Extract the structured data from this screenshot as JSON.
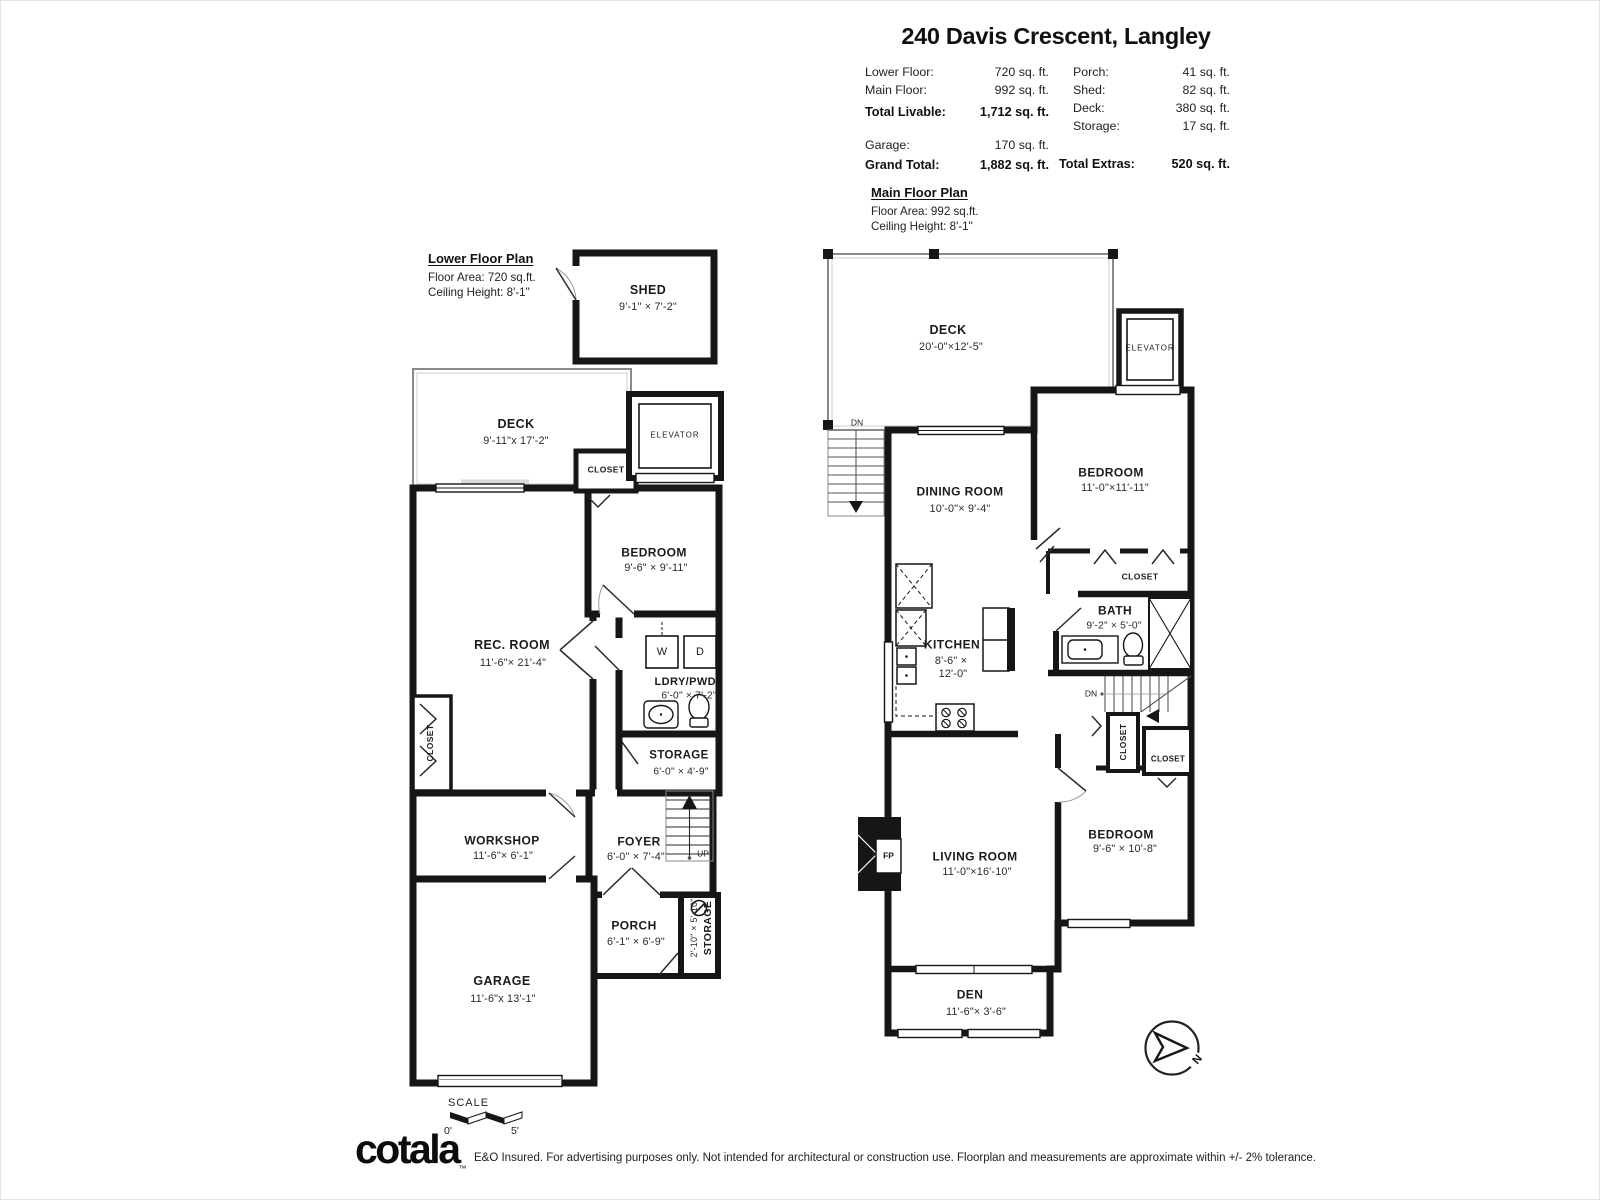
{
  "header": {
    "title": "240 Davis Crescent, Langley",
    "left_stats": [
      {
        "label": "Lower Floor:",
        "value": "720 sq. ft."
      },
      {
        "label": "Main Floor:",
        "value": "992 sq. ft."
      },
      {
        "label": "Total Livable:",
        "value": "1,712 sq. ft."
      },
      {
        "label": "Garage:",
        "value": "170 sq. ft."
      },
      {
        "label": "Grand Total:",
        "value": "1,882 sq. ft."
      }
    ],
    "right_stats": [
      {
        "label": "Porch:",
        "value": "41 sq. ft."
      },
      {
        "label": "Shed:",
        "value": "82 sq. ft."
      },
      {
        "label": "Deck:",
        "value": "380 sq. ft."
      },
      {
        "label": "Storage:",
        "value": "17 sq. ft."
      },
      {
        "label": "Total Extras:",
        "value": "520 sq. ft."
      }
    ]
  },
  "lower_plan": {
    "heading": "Lower Floor Plan",
    "floor_area": "Floor Area: 720 sq.ft.",
    "ceiling_height": "Ceiling Height: 8'-1\"",
    "rooms": {
      "shed": {
        "name": "SHED",
        "dims": "9'-1\" × 7'-2\""
      },
      "deck": {
        "name": "DECK",
        "dims": "9'-11\"x 17'-2\""
      },
      "elevator": {
        "name": "ELEVATOR"
      },
      "closet_top": {
        "name": "CLOSET"
      },
      "bedroom": {
        "name": "BEDROOM",
        "dims": "9'-6\" × 9'-11\""
      },
      "rec_room": {
        "name": "REC. ROOM",
        "dims": "11'-6\"× 21'-4\""
      },
      "laundry": {
        "name": "LDRY/PWD.",
        "dims": "6'-0\" × 7'-2\"",
        "washer": "W",
        "dryer": "D"
      },
      "storage": {
        "name": "STORAGE",
        "dims": "6'-0\" × 4'-9\""
      },
      "closet_left": {
        "name": "CLOSET"
      },
      "workshop": {
        "name": "WORKSHOP",
        "dims": "11'-6\"× 6'-1\""
      },
      "foyer": {
        "name": "FOYER",
        "dims": "6'-0\" × 7'-4\"",
        "stairs": "UP"
      },
      "porch": {
        "name": "PORCH",
        "dims": "6'-1\" × 6'-9\""
      },
      "storage_side": {
        "name": "STORAGE",
        "dims": "2'-10\" × 5'-10\""
      },
      "garage": {
        "name": "GARAGE",
        "dims": "11'-6\"x 13'-1\""
      }
    }
  },
  "main_plan": {
    "heading": "Main Floor Plan",
    "floor_area": "Floor Area: 992 sq.ft.",
    "ceiling_height": "Ceiling Height: 8'-1\"",
    "rooms": {
      "deck": {
        "name": "DECK",
        "dims": "20'-0\"×12'-5\""
      },
      "stairs_top": {
        "label": "DN"
      },
      "elevator": {
        "name": "ELEVATOR"
      },
      "dining": {
        "name": "DINING ROOM",
        "dims": "10'-0\"× 9'-4\""
      },
      "bedroom1": {
        "name": "BEDROOM",
        "dims": "11'-0\"×11'-11\""
      },
      "closet1": {
        "name": "CLOSET"
      },
      "bath": {
        "name": "BATH",
        "dims": "9'-2\" × 5'-0\""
      },
      "kitchen": {
        "name": "KITCHEN",
        "dims_line1": "8'-6\" ×",
        "dims_line2": "12'-0\""
      },
      "stairs_mid": {
        "label": "DN"
      },
      "closet_mid": {
        "name": "CLOSET"
      },
      "closet_small": {
        "name": "CLOSET"
      },
      "living": {
        "name": "LIVING ROOM",
        "dims": "11'-0\"×16'-10\"",
        "fireplace": "FP"
      },
      "bedroom2": {
        "name": "BEDROOM",
        "dims": "9'-6\" × 10'-8\""
      },
      "den": {
        "name": "DEN",
        "dims": "11'-6\"× 3'-6\""
      }
    }
  },
  "scale_bar": {
    "label": "SCALE",
    "start": "0'",
    "end": "5'"
  },
  "compass": {
    "north": "N"
  },
  "footer": {
    "brand": "cotala",
    "tm": "™",
    "disclaimer": "E&O Insured. For advertising purposes only. Not intended for architectural or construction use. Floorplan and measurements are approximate within +/- 2% tolerance."
  }
}
